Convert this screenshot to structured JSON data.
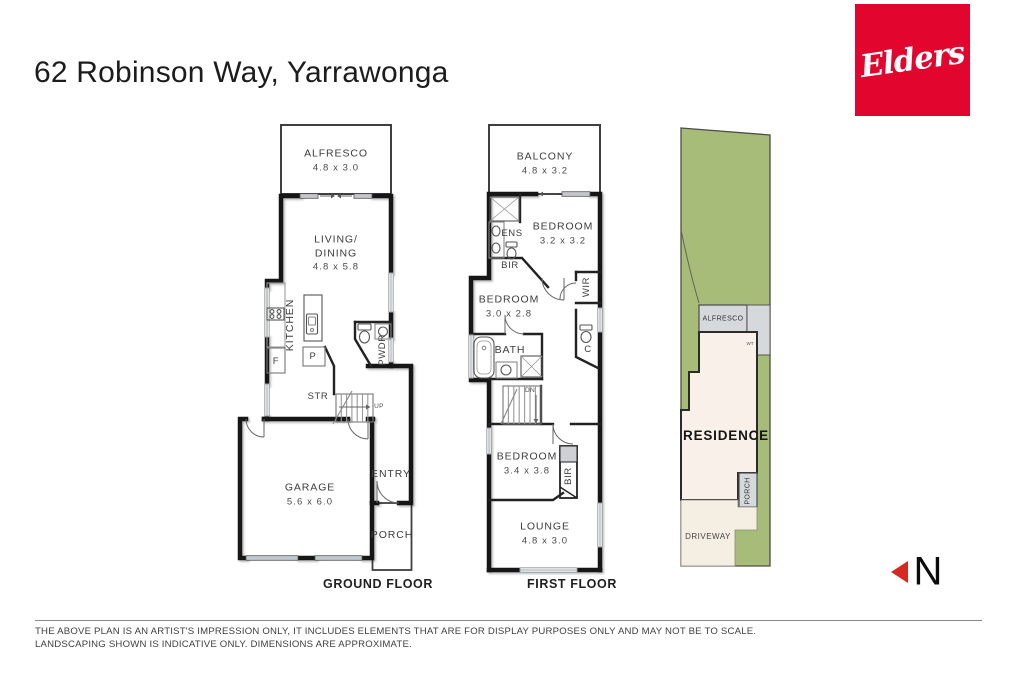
{
  "page": {
    "title": "62 Robinson Way, Yarrawonga"
  },
  "logo": {
    "text": "Elders",
    "bg_color": "#E2052E"
  },
  "ground_floor": {
    "caption": "GROUND FLOOR",
    "alfresco": {
      "name": "ALFRESCO",
      "dims": "4.8 x 3.0"
    },
    "living": {
      "name1": "LIVING/",
      "name2": "DINING",
      "dims": "4.8 x 5.8"
    },
    "kitchen": "KITCHEN",
    "fridge": "F",
    "pantry": "P",
    "powder": "PWDR",
    "storage": "STR",
    "stairs_up": "UP",
    "garage": {
      "name": "GARAGE",
      "dims": "5.6 x 6.0"
    },
    "entry": "ENTRY",
    "porch": "PORCH"
  },
  "first_floor": {
    "caption": "FIRST FLOOR",
    "balcony": {
      "name": "BALCONY",
      "dims": "4.8 x 3.2"
    },
    "ensuite": "ENS",
    "bedroom1": {
      "name": "BEDROOM",
      "dims": "3.2 x 3.2"
    },
    "robe1": "BIR",
    "walk_in_robe": "WIR",
    "bedroom2": {
      "name": "BEDROOM",
      "dims": "3.0 x 2.8"
    },
    "bath": "BATH",
    "cupboard": "C",
    "stairs_down": "DN",
    "bedroom3": {
      "name": "BEDROOM",
      "dims": "3.4 x 3.8"
    },
    "robe2": "BIR",
    "lounge": {
      "name": "LOUNGE",
      "dims": "4.8 x 3.0"
    }
  },
  "site_plan": {
    "alfresco": "ALFRESCO",
    "water_tank": "WT",
    "residence": "RESIDENCE",
    "porch": "PORCH",
    "driveway": "DRIVEWAY"
  },
  "compass": {
    "letter": "N"
  },
  "disclaimer": {
    "line1": "THE ABOVE PLAN IS AN ARTIST'S IMPRESSION ONLY, IT INCLUDES ELEMENTS THAT ARE FOR DISPLAY PURPOSES ONLY AND MAY NOT BE TO SCALE.",
    "line2": "LANDSCAPING SHOWN IS INDICATIVE ONLY. DIMENSIONS ARE APPROXIMATE."
  },
  "colors": {
    "brand_red": "#E2052E",
    "lot_green": "#A8BC79",
    "residence_fill": "#F9F0EA",
    "driveway_fill": "#F5EEE3",
    "north_red": "#D42A24",
    "wall_black": "#161616"
  }
}
